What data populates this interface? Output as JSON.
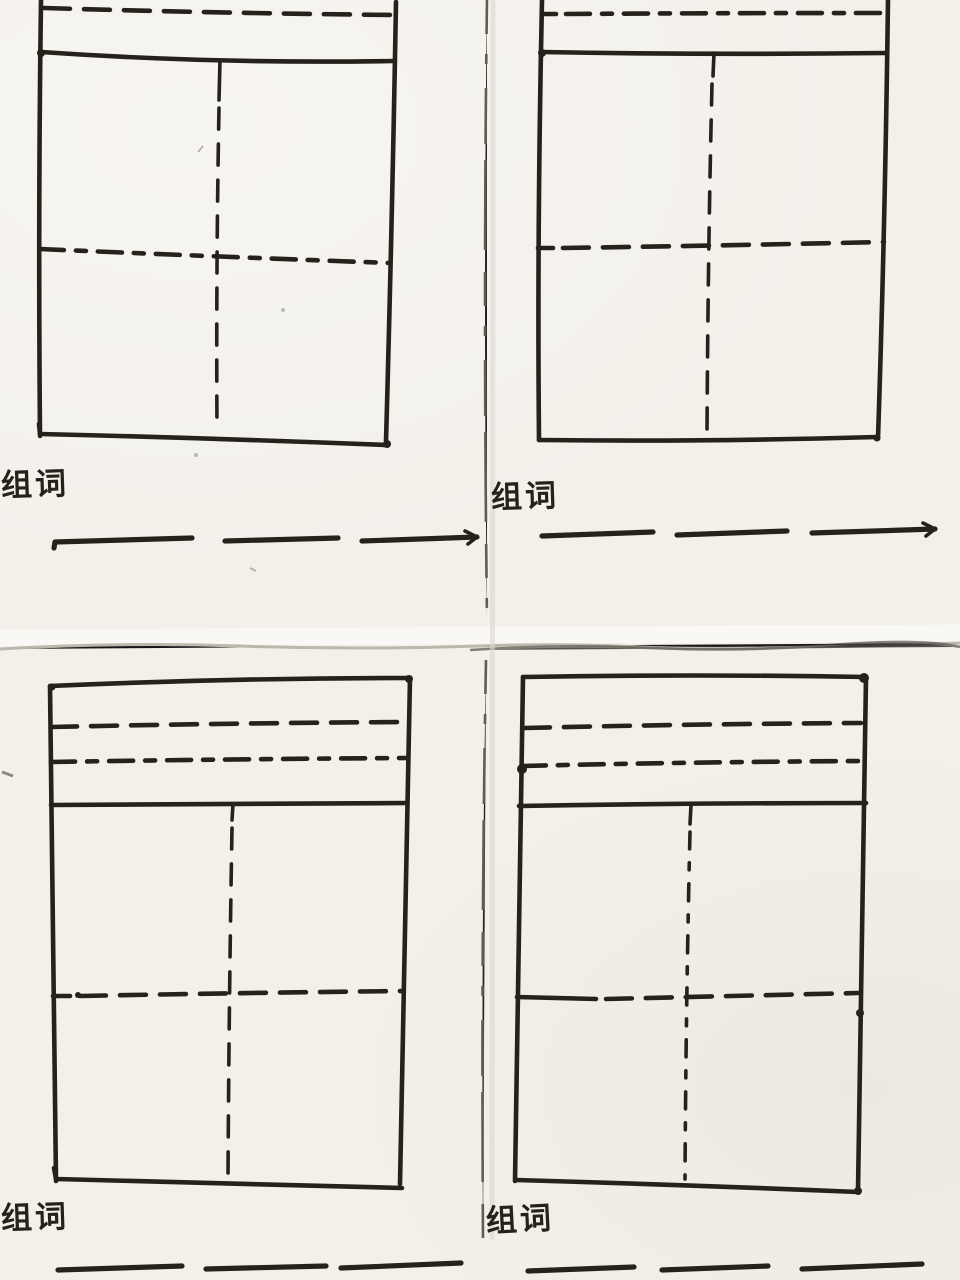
{
  "colors": {
    "ink": "#25221c",
    "paper": "#f3f0ea",
    "paper_highlight": "#fbfaf6",
    "crease": "#b7b1a6",
    "fold_line": "#46423c"
  },
  "cards": [
    {
      "position": "top-left",
      "word_label": "组词",
      "writing_line_segments": 3,
      "grid": "tian-zi-ge cross-guide practice box, cropped at top edge",
      "pinyin_guide_lines_visible": 1
    },
    {
      "position": "top-right",
      "word_label": "组词",
      "writing_line_segments": 3,
      "grid": "tian-zi-ge cross-guide practice box, cropped at top edge",
      "pinyin_guide_lines_visible": 1
    },
    {
      "position": "bottom-left",
      "word_label": "组词",
      "writing_line_segments": 3,
      "grid": "tian-zi-ge cross-guide practice box",
      "pinyin_guide_lines_visible": 2
    },
    {
      "position": "bottom-right",
      "word_label": "组词",
      "writing_line_segments": 3,
      "grid": "tian-zi-ge cross-guide practice box",
      "pinyin_guide_lines_visible": 2
    }
  ]
}
